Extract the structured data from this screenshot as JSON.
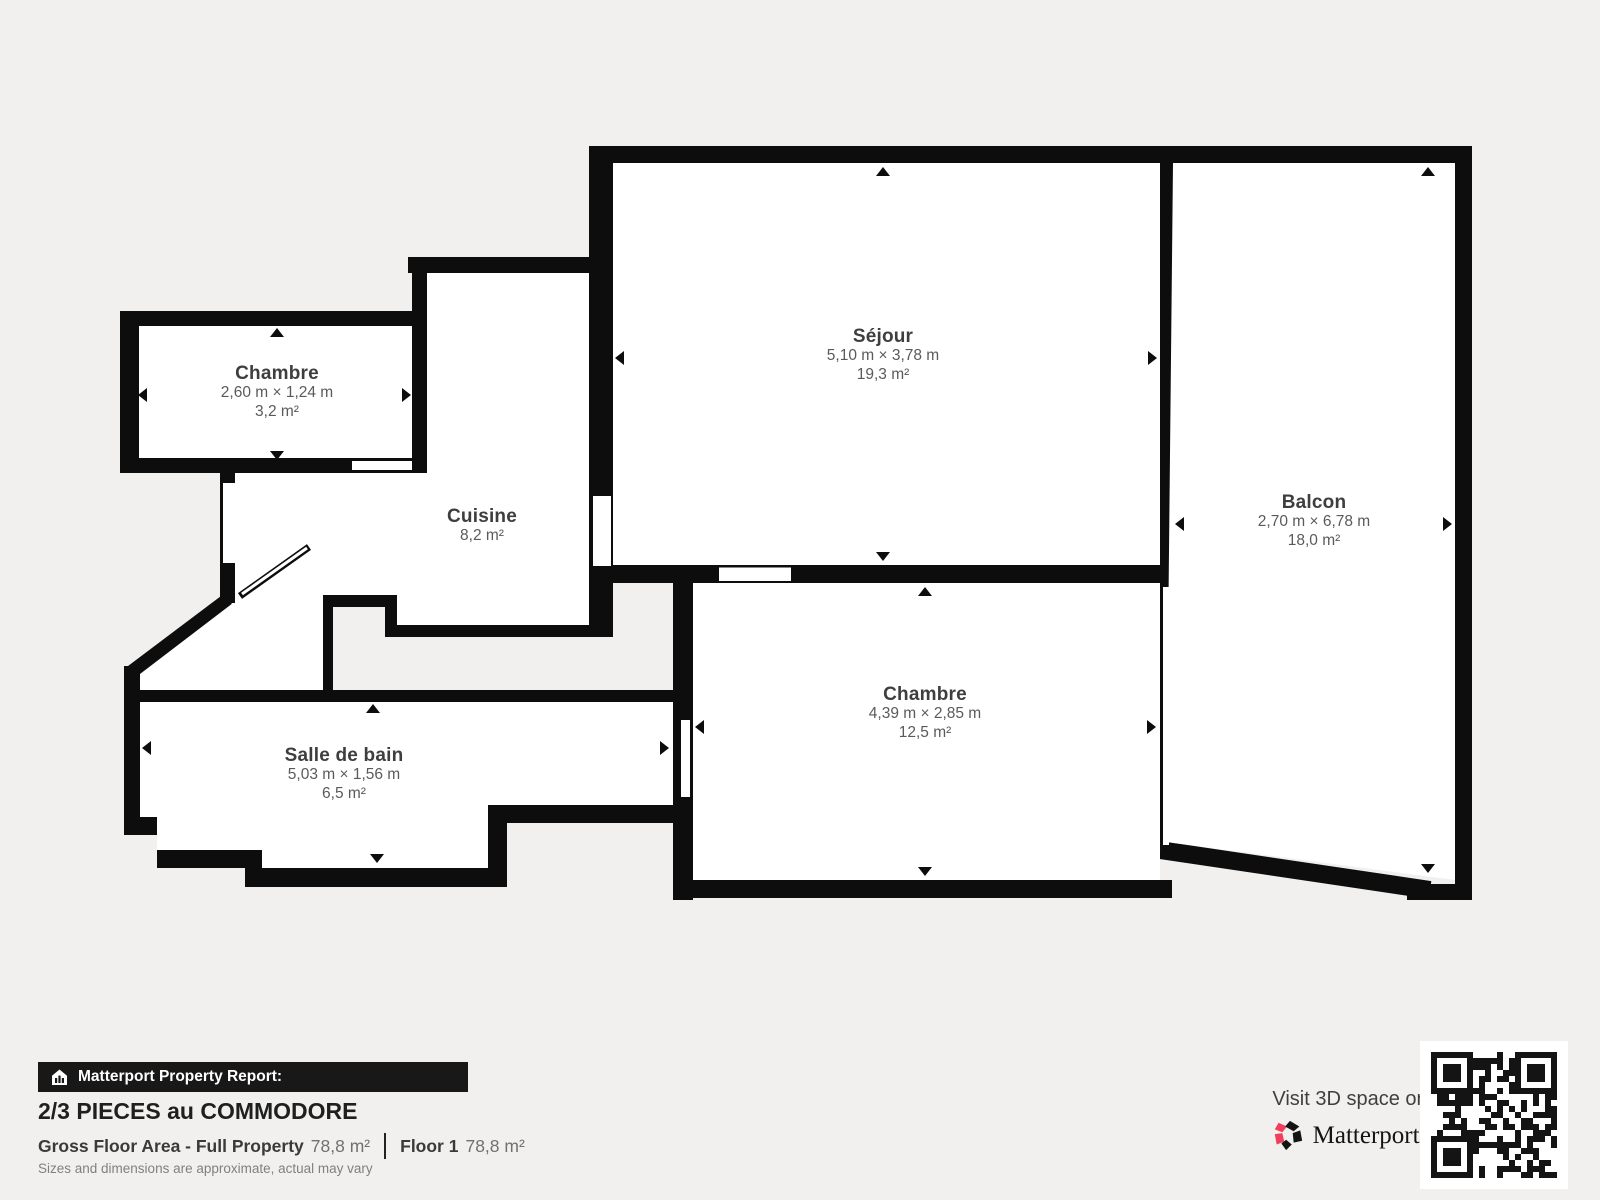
{
  "plan": {
    "rooms": [
      {
        "key": "chambre-1",
        "name": "Chambre",
        "dims": "2,60 m × 1,24 m",
        "area": "3,2 m²"
      },
      {
        "key": "cuisine",
        "name": "Cuisine",
        "dims": "",
        "area": "8,2 m²"
      },
      {
        "key": "sejour",
        "name": "Séjour",
        "dims": "5,10 m × 3,78 m",
        "area": "19,3 m²"
      },
      {
        "key": "balcon",
        "name": "Balcon",
        "dims": "2,70 m × 6,78 m",
        "area": "18,0 m²"
      },
      {
        "key": "chambre-2",
        "name": "Chambre",
        "dims": "4,39 m × 2,85 m",
        "area": "12,5 m²"
      },
      {
        "key": "salle-de-bain",
        "name": "Salle de bain",
        "dims": "5,03 m × 1,56 m",
        "area": "6,5 m²"
      }
    ],
    "wall_color": "#0d0d0d",
    "room_fill": "#ffffff",
    "background": "#f1f0ee"
  },
  "report": {
    "banner": "Matterport Property Report:",
    "property_title": "2/3 PIECES au COMMODORE",
    "gross_floor_area_label": "Gross Floor Area - Full Property",
    "gross_floor_area_value": "78,8 m²",
    "floor_label": "Floor 1",
    "floor_value": "78,8 m²",
    "disclaimer": "Sizes and dimensions are approximate, actual may vary"
  },
  "promo": {
    "visit_text": "Visit 3D space on",
    "brand": "Matterport",
    "trademark": "™",
    "brand_accent": "#ef3f5d"
  }
}
